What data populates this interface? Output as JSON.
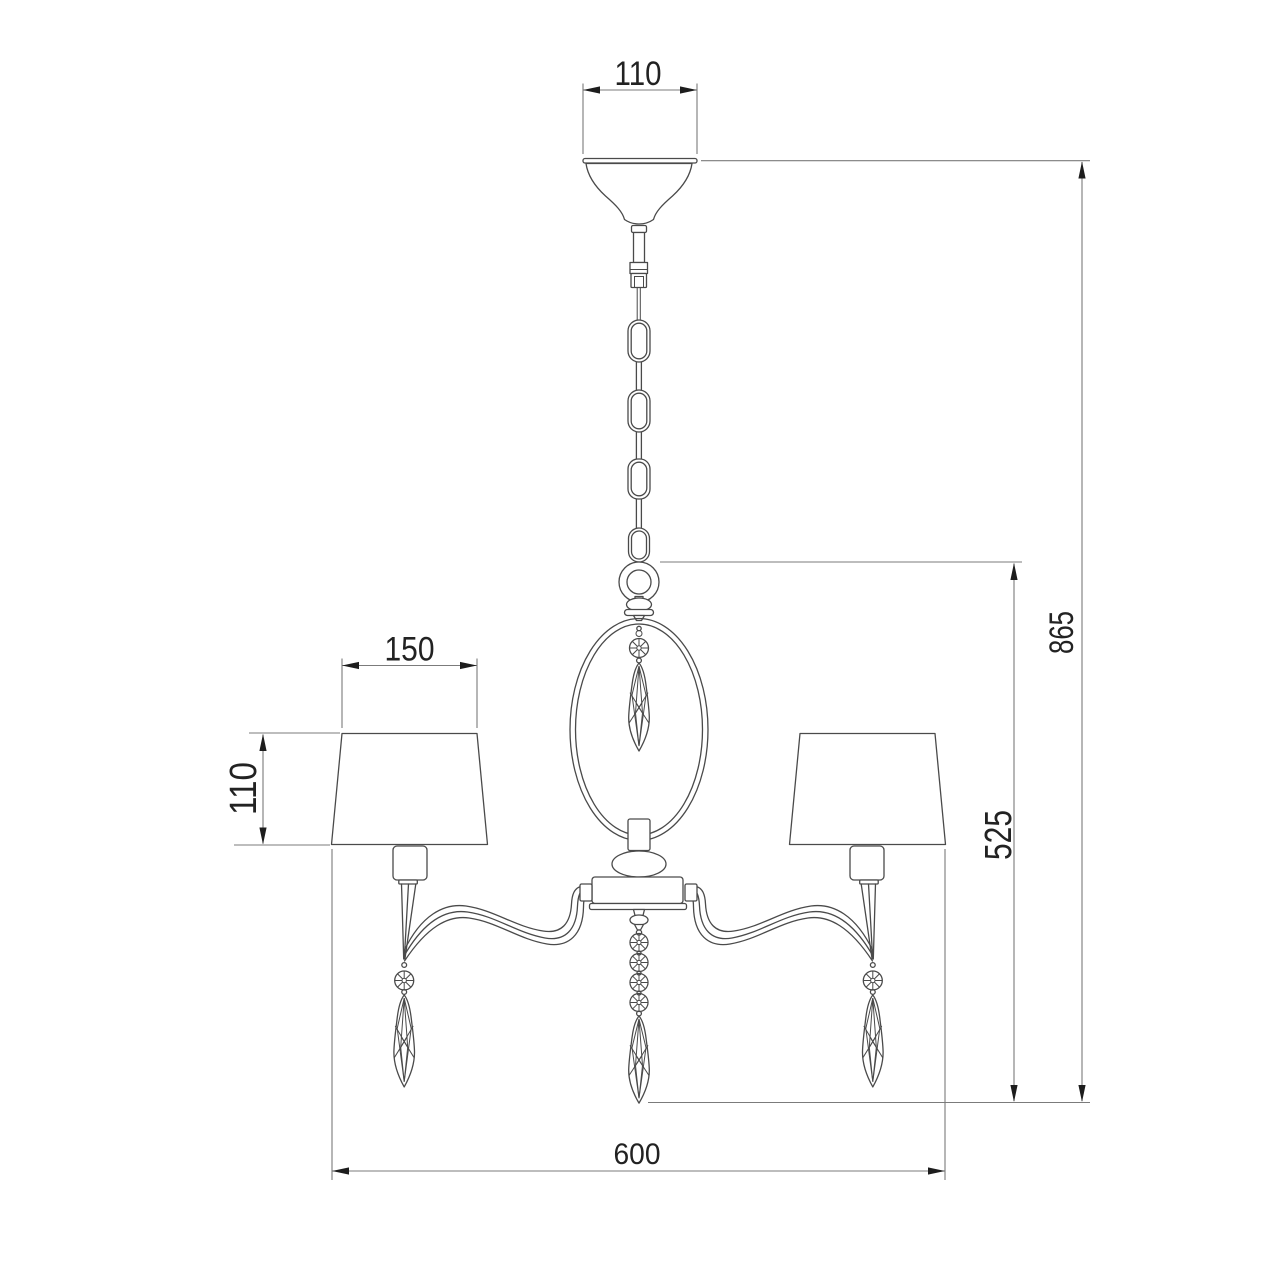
{
  "drawing": {
    "title": "Chandelier technical dimension drawing",
    "style": "line-art",
    "background_color": "#ffffff",
    "line_color": "#4a4a4a",
    "dimension_line_color": "#7b7b7b",
    "text_color": "#222222"
  },
  "dimensions": {
    "canopy_width": "110",
    "overall_height": "865",
    "body_drop_height": "525",
    "shade_width": "150",
    "shade_height": "110",
    "fixture_width": "600"
  }
}
